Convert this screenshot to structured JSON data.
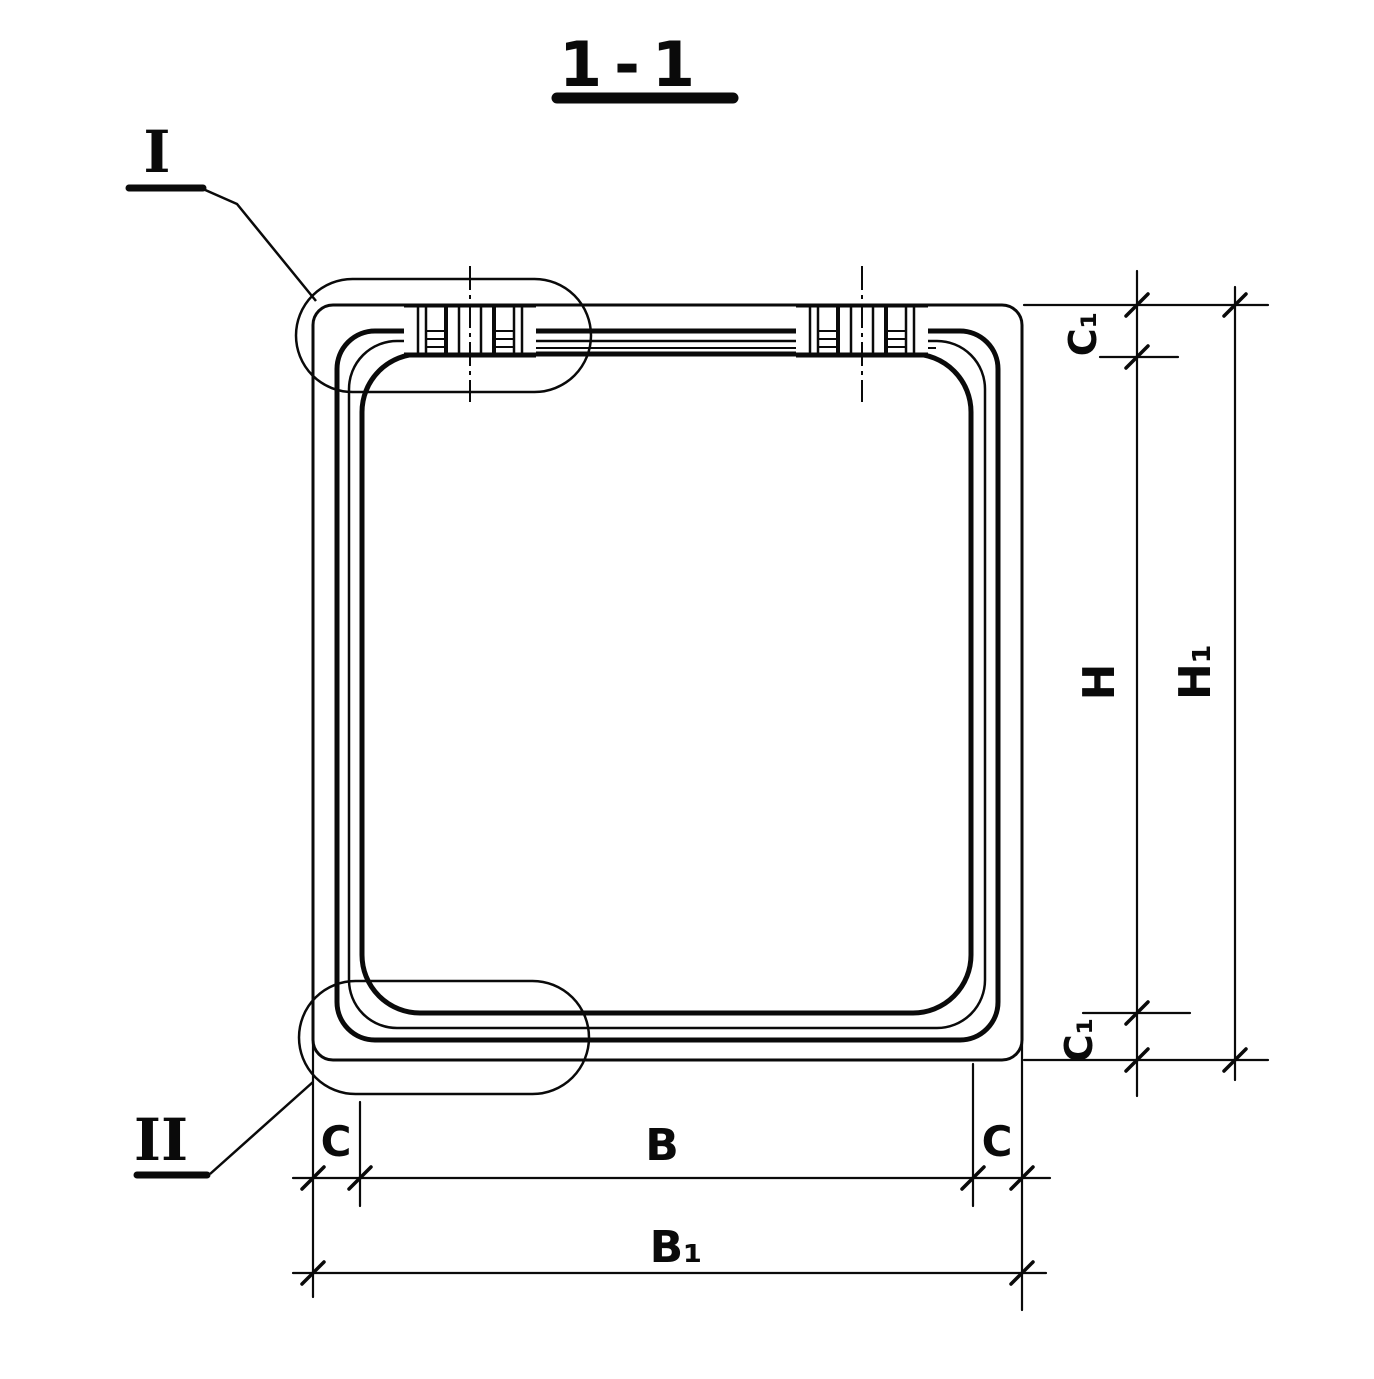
{
  "title": {
    "label": "1-1"
  },
  "callouts": {
    "detail_1": "I",
    "detail_2": "II"
  },
  "dimensions": {
    "c1_top": "C₁",
    "h_inner": "H",
    "h1_outer": "H₁",
    "c1_bottom": "C₁",
    "c_left": "C",
    "b_inner": "B",
    "c_right": "C",
    "b1_outer": "B₁"
  },
  "colors": {
    "ink": "#0a0a0a",
    "background": "#ffffff"
  }
}
